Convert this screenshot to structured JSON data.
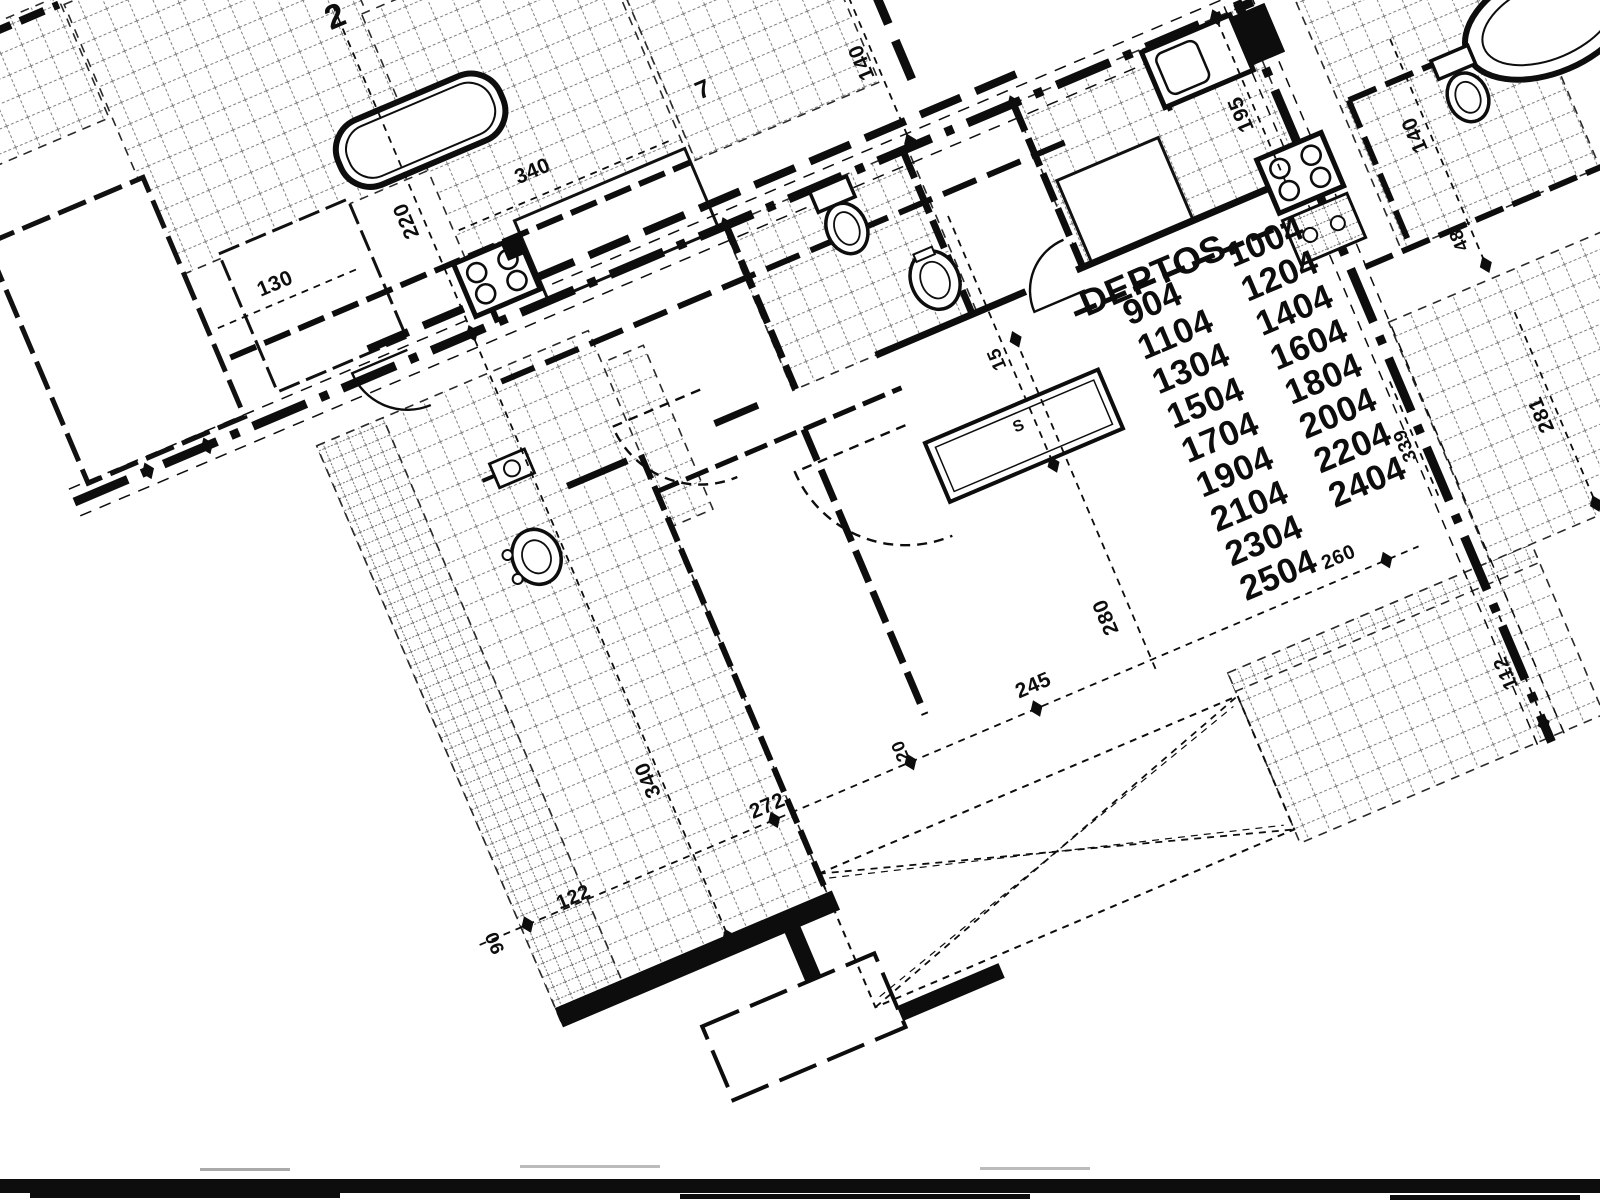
{
  "scan": {
    "paper_color": "#ffffff",
    "ink_color": "#0d0d0d",
    "plan_rotation_deg": -23
  },
  "deptos": {
    "header": "DEPTOS.",
    "column1": [
      "904",
      "1104",
      "1304",
      "1504",
      "1704",
      "1904",
      "2104",
      "2304",
      "2504"
    ],
    "column2": [
      "1004",
      "1204",
      "1404",
      "1604",
      "1804",
      "2004",
      "2204",
      "2404"
    ],
    "layout": {
      "header_pos": [
        1104,
        437
      ],
      "header_size": 37,
      "col1": {
        "x": 1140,
        "y0": 462,
        "dy": 37.4
      },
      "col2": {
        "x": 1258,
        "y0": 449,
        "dy": 37.3
      },
      "font_size": 35
    }
  },
  "dimension_labels": [
    {
      "text": "340",
      "x": 651,
      "y": 93,
      "vertical": false,
      "size": 21
    },
    {
      "text": "220",
      "x": 522,
      "y": 83,
      "vertical": true,
      "size": 21
    },
    {
      "text": "130",
      "x": 370,
      "y": 96,
      "vertical": false,
      "size": 21
    },
    {
      "text": "140",
      "x": 1003,
      "y": 115,
      "vertical": true,
      "size": 21
    },
    {
      "text": "195",
      "x": 1332,
      "y": 311,
      "vertical": true,
      "size": 21
    },
    {
      "text": "140",
      "x": 1484,
      "y": 398,
      "vertical": true,
      "size": 21
    },
    {
      "text": "48",
      "x": 1483,
      "y": 512,
      "vertical": true,
      "size": 19
    },
    {
      "text": "15",
      "x": 1011,
      "y": 441,
      "vertical": true,
      "size": 19
    },
    {
      "text": "281",
      "x": 1491,
      "y": 705,
      "vertical": true,
      "size": 21
    },
    {
      "text": "339",
      "x": 1353,
      "y": 680,
      "vertical": true,
      "size": 19
    },
    {
      "text": "280",
      "x": 1011,
      "y": 721,
      "vertical": true,
      "size": 21
    },
    {
      "text": "260",
      "x": 1242,
      "y": 763,
      "vertical": false,
      "size": 20
    },
    {
      "text": "245",
      "x": 911,
      "y": 762,
      "vertical": false,
      "size": 21
    },
    {
      "text": "272",
      "x": 619,
      "y": 769,
      "vertical": false,
      "size": 21
    },
    {
      "text": "340",
      "x": 526,
      "y": 692,
      "vertical": true,
      "size": 21
    },
    {
      "text": "122",
      "x": 405,
      "y": 777,
      "vertical": false,
      "size": 20
    },
    {
      "text": "90",
      "x": 321,
      "y": 782,
      "vertical": true,
      "size": 19
    },
    {
      "text": "20",
      "x": 769,
      "y": 764,
      "vertical": true,
      "size": 18
    },
    {
      "text": "112",
      "x": 1357,
      "y": 929,
      "vertical": true,
      "size": 20
    }
  ],
  "annotations": [
    {
      "text": "7",
      "x": 840,
      "y": 86,
      "vertical": false,
      "size": 25
    },
    {
      "text": "S",
      "x": 999,
      "y": 516,
      "vertical": false,
      "size": 16
    },
    {
      "text": "2",
      "x": 530,
      "y": -122,
      "vertical": false,
      "size": 34
    }
  ]
}
